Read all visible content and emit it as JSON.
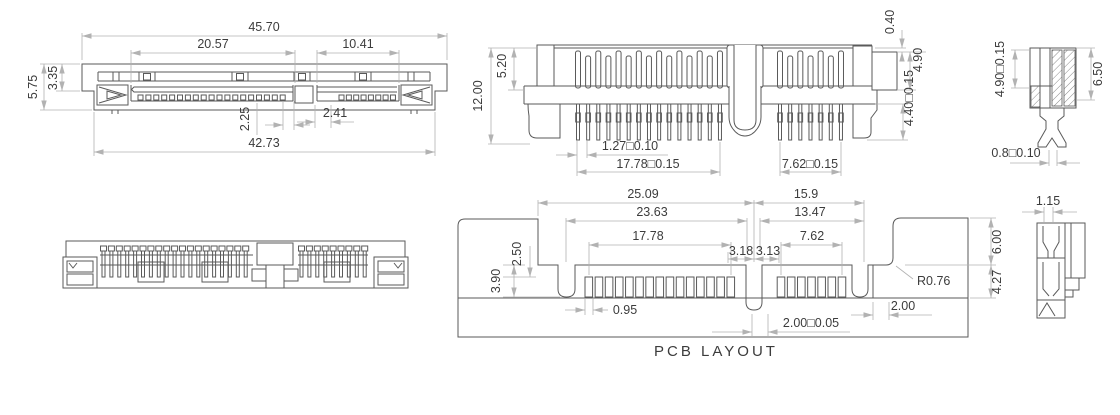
{
  "front_view": {
    "overall_width": "45.70",
    "power_segment_width": "20.57",
    "signal_segment_width": "10.41",
    "total_height": "5.75",
    "upper_body_height": "3.35",
    "power_key_offset": "2.25",
    "signal_key_offset": "2.41",
    "lower_body_width": "42.73"
  },
  "rear_view": {
    "overall_height": "12.00",
    "housing_height": "5.20",
    "latch_step": "0.40",
    "latch_height": "4.90",
    "tail_length": "4.40□0.15",
    "pin_pitch": "1.27□0.10",
    "power_pin_span": "17.78□0.15",
    "signal_pin_span": "7.62□0.15"
  },
  "section_view": {
    "contact_height": "4.90□0.15",
    "overall_height": "6.50",
    "tail_width": "0.8□0.10"
  },
  "pcb_layout": {
    "title": "PCB LAYOUT",
    "power_center_span": "25.09",
    "signal_center_span": "15.9",
    "power_outline_span": "23.63",
    "signal_outline_span": "13.47",
    "power_pad_span": "17.78",
    "signal_pad_span": "7.62",
    "key_left": "3.18",
    "key_right": "3.13",
    "pad_length": "2.50",
    "pad_offset": "3.90",
    "pad_width": "0.95",
    "pad_pitch_tol": "2.00□0.05",
    "edge_clearance": "2.00",
    "corner_radius": "R0.76",
    "tab_height": "6.00",
    "tab_lower_height": "4.27"
  },
  "side_view": {
    "pin_thickness": "1.15"
  },
  "colors": {
    "object_line": "#5a5a5a",
    "dimension_line": "#b2b2b2",
    "text": "#3c3c3c",
    "background": "#ffffff"
  }
}
